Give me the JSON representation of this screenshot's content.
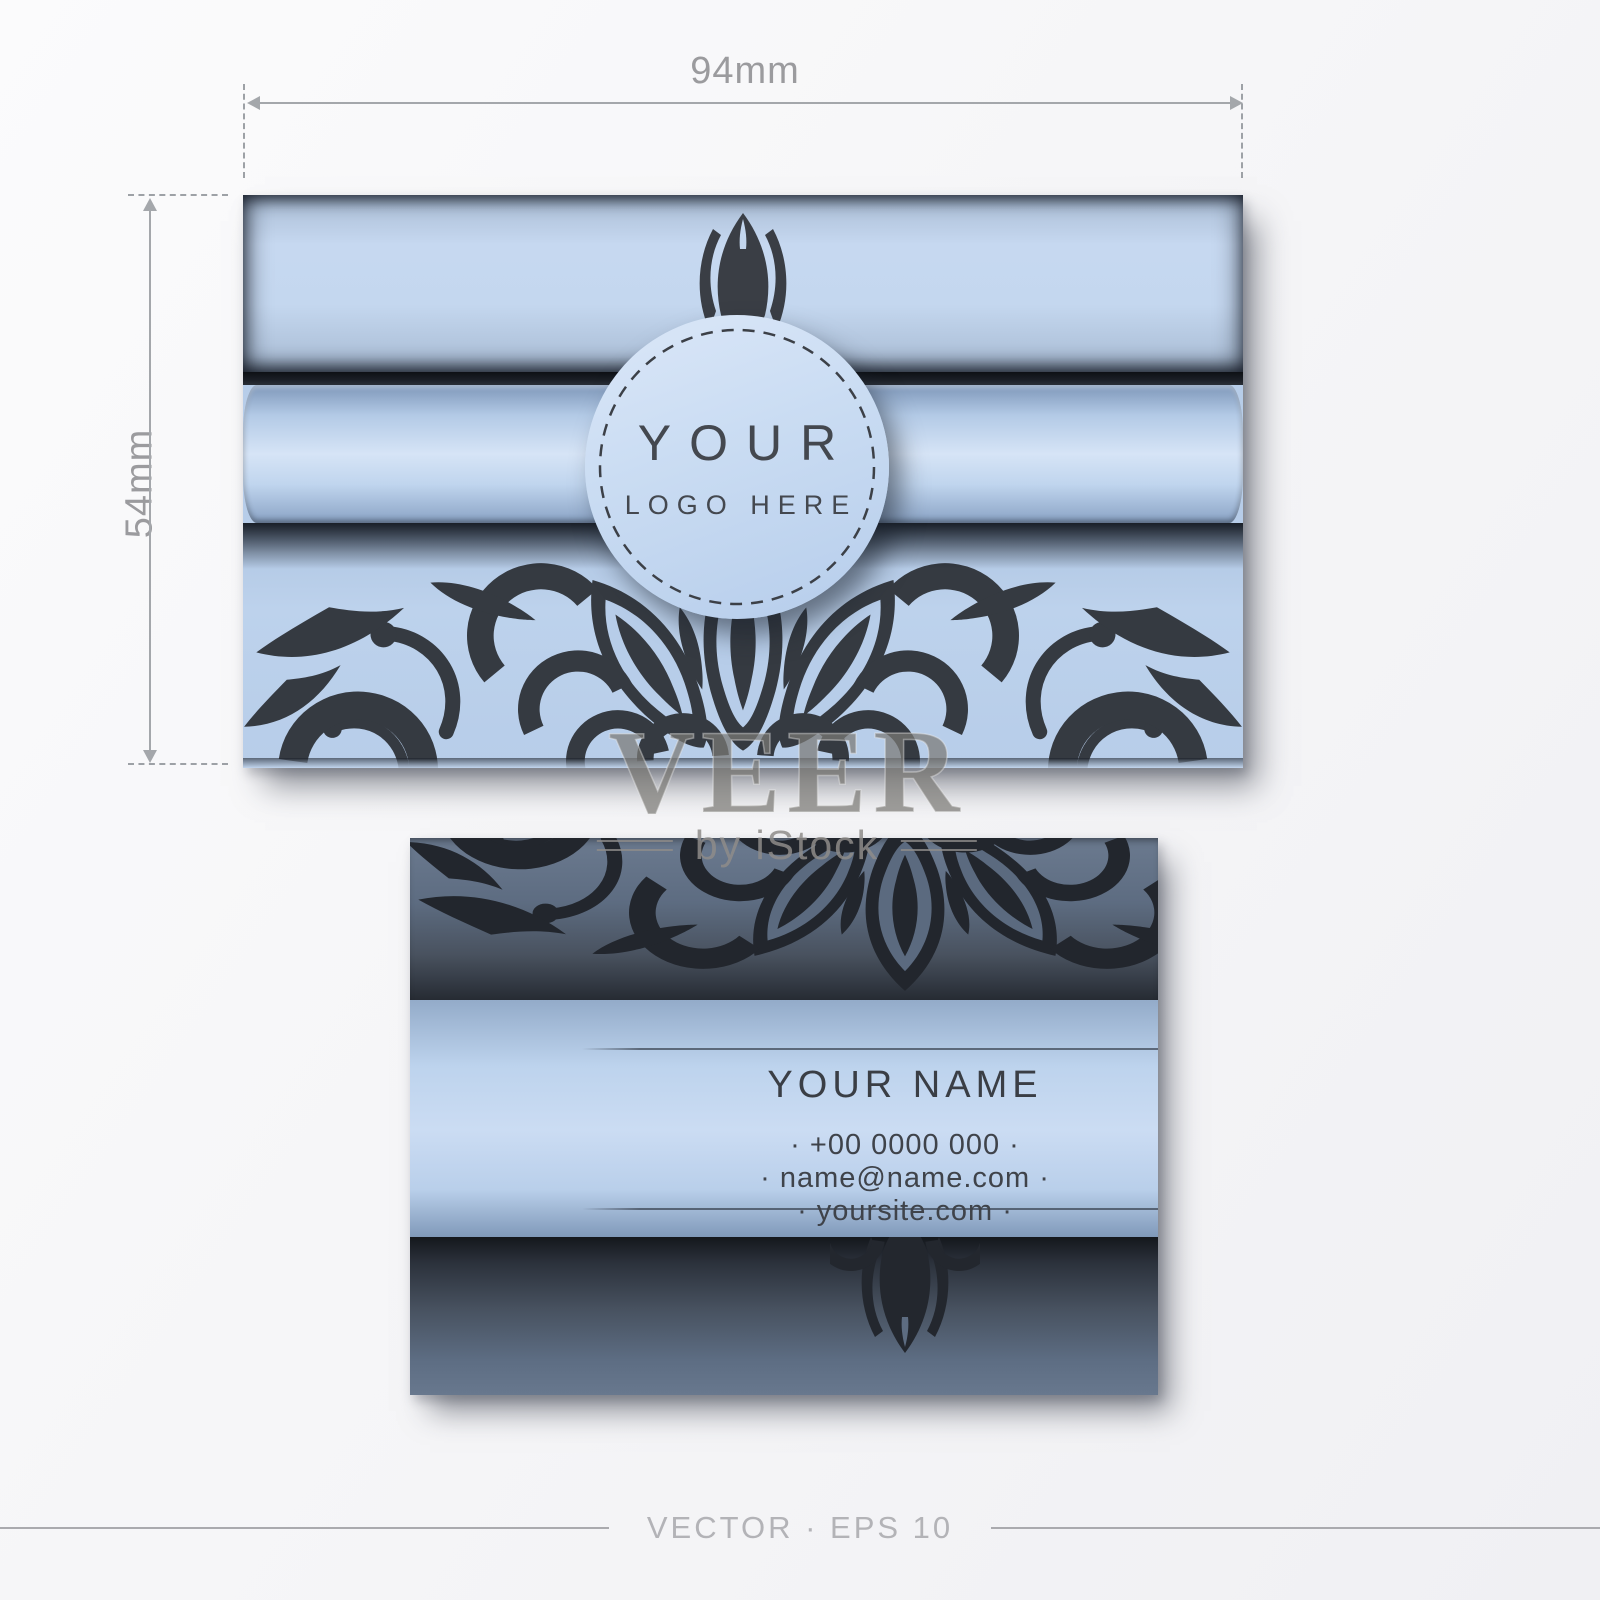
{
  "dimensions": {
    "width_label": "94mm",
    "height_label": "54mm"
  },
  "front_card": {
    "logo_line1": "YOUR",
    "logo_line2": "LOGO HERE"
  },
  "back_card": {
    "name": "YOUR NAME",
    "phone": "· +00 0000 000 ·",
    "email": "· name@name.com ·",
    "website": "· yoursite.com ·"
  },
  "watermark": {
    "brand": "VEER",
    "byline": "by iStock"
  },
  "footer": {
    "caption": "VECTOR · EPS 10"
  },
  "colors": {
    "card_light_blue": "#c2d6ee",
    "band_highlight_blue": "#d6e4f6",
    "ornament_charcoal": "#353a41",
    "back_slate": "#5d6c81",
    "back_slate_dark": "#262b33",
    "annotation_gray": "#9b9b9e",
    "watermark_gray": "#8e8c8a",
    "background": "#f6f6f8"
  }
}
